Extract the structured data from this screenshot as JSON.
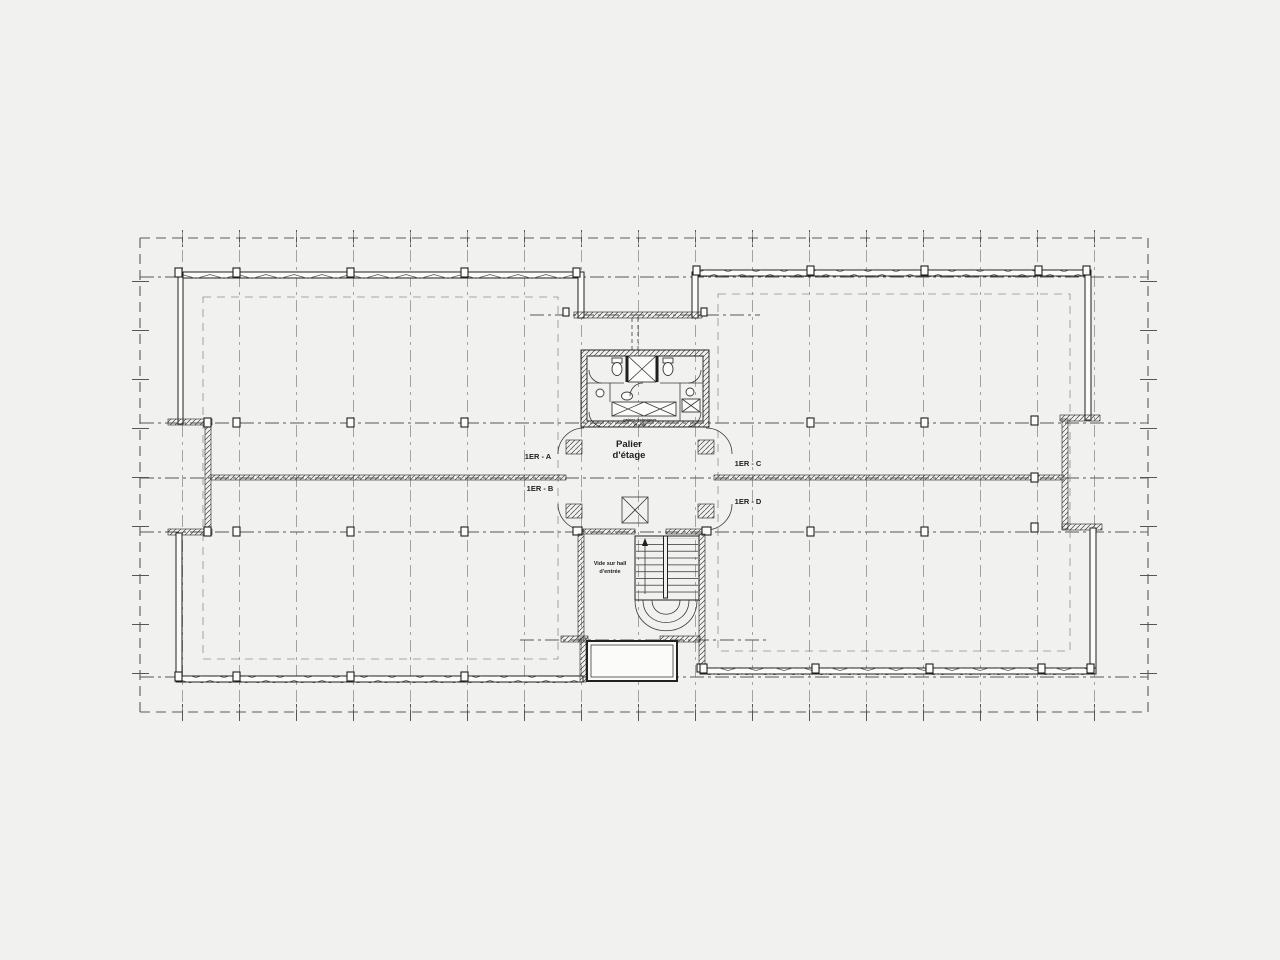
{
  "colors": {
    "bg": "#f1f1ef",
    "ink": "#1f1f1f",
    "ink_light": "#8b8b8b"
  },
  "plan": {
    "landing": {
      "line1": "Palier",
      "line2": "d'étage"
    },
    "void": {
      "line1": "Vide sur hall",
      "line2": "d'entrée"
    },
    "duct_note": {
      "line1": "gaines techniques",
      "line2": "et vide"
    },
    "zones": {
      "a": "1ER - A",
      "b": "1ER - B",
      "c": "1ER - C",
      "d": "1ER - D"
    }
  }
}
